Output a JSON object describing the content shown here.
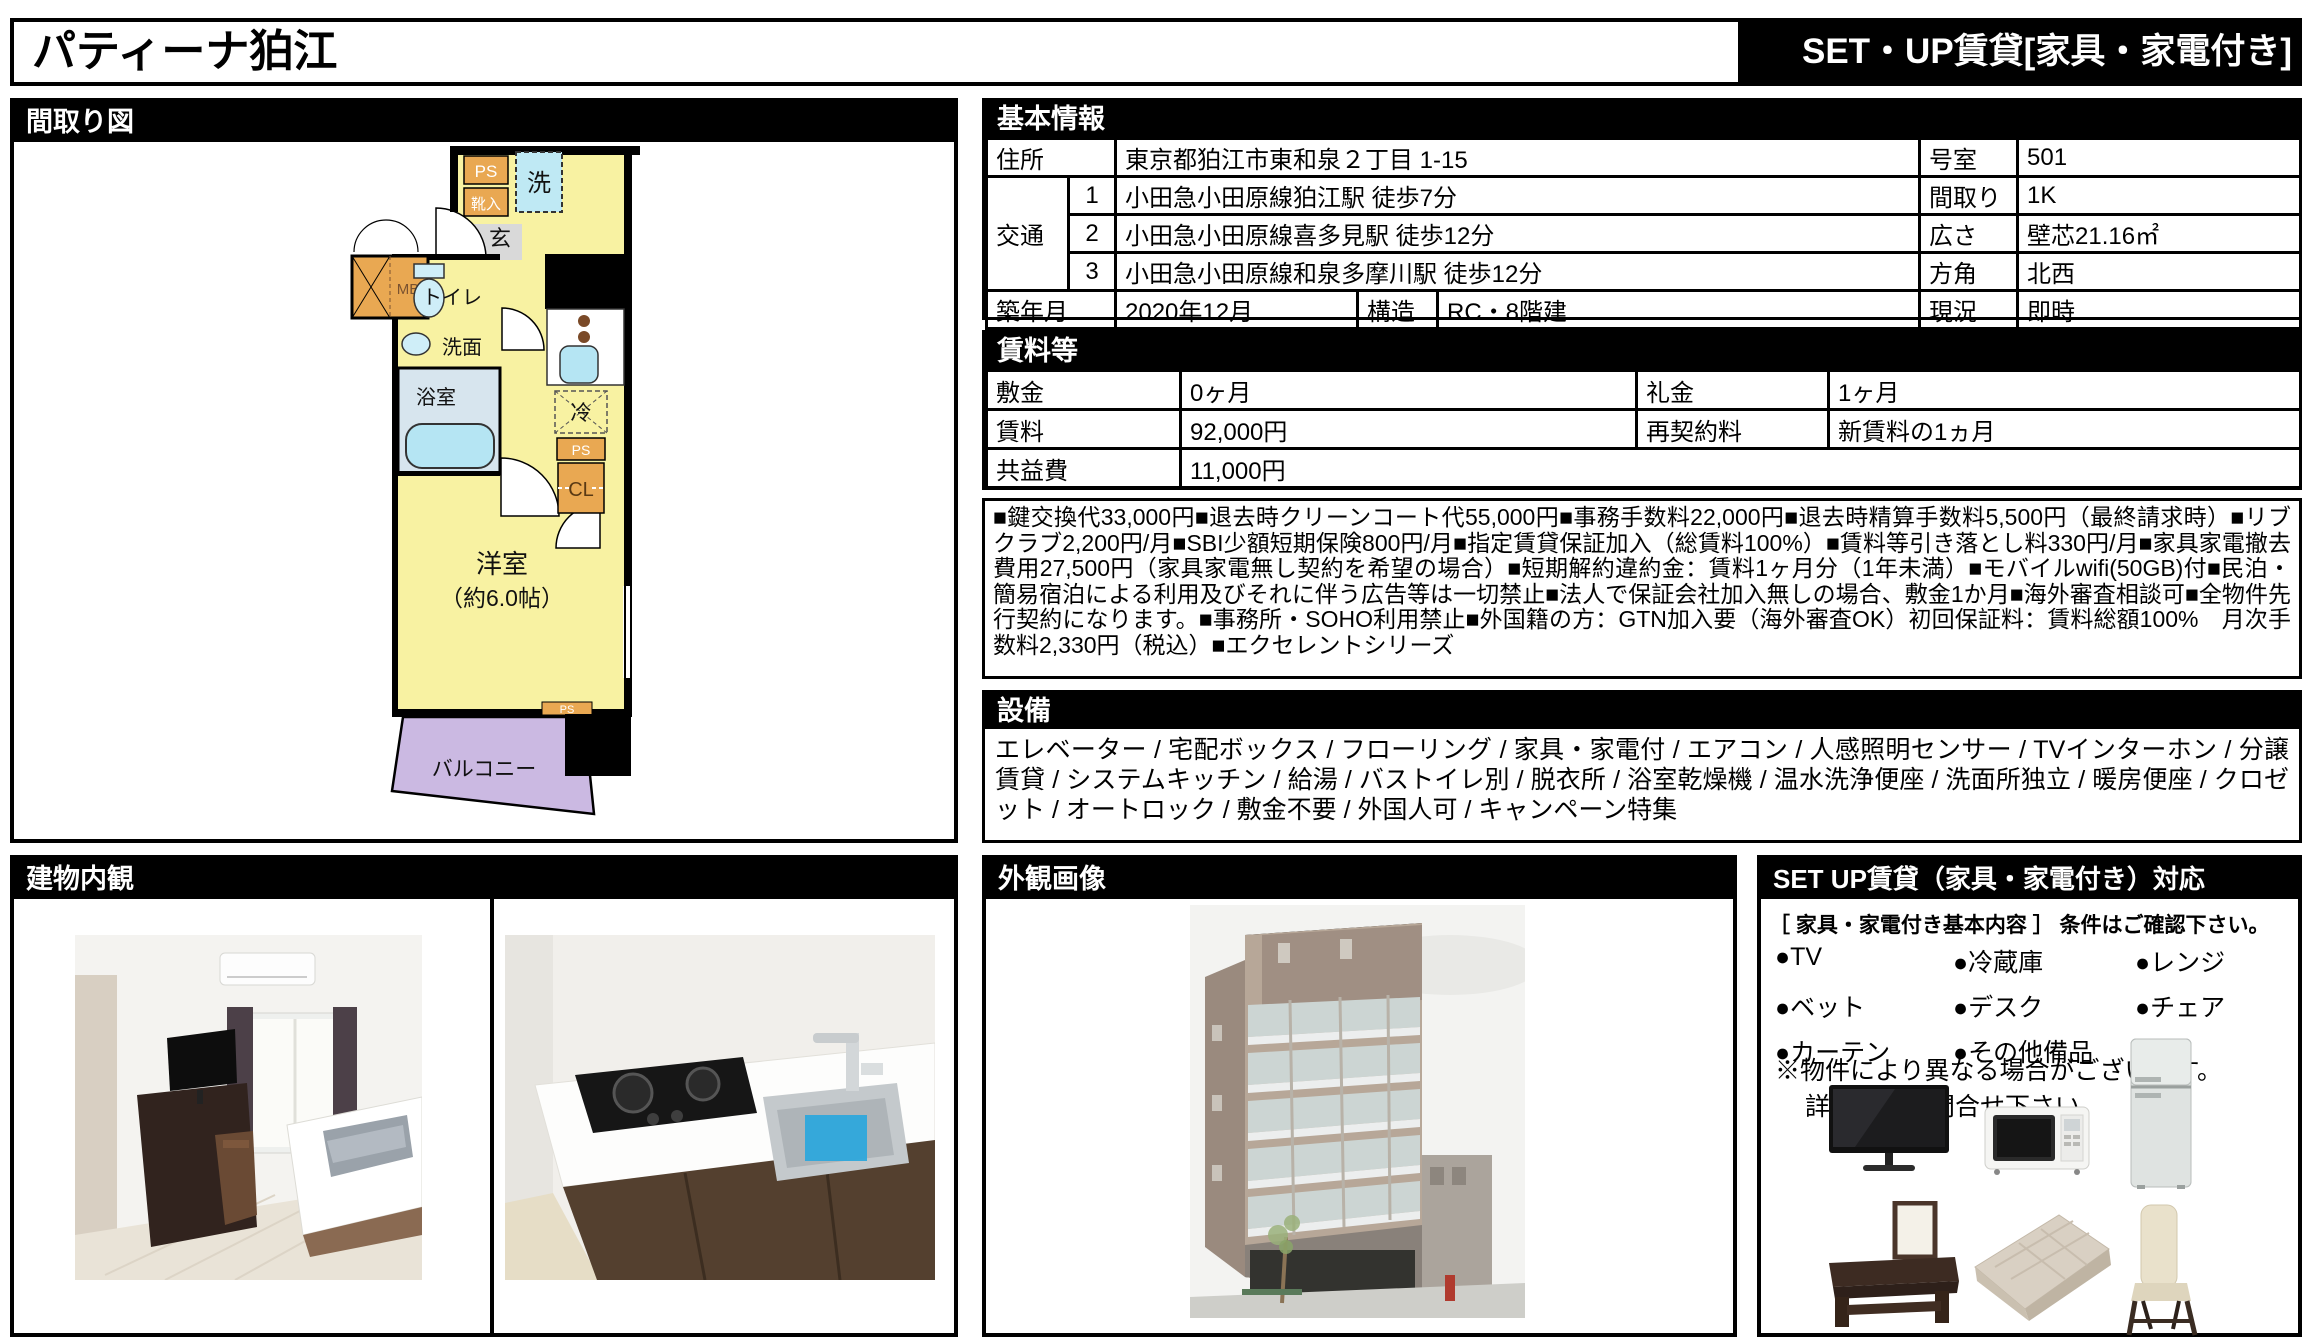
{
  "header": {
    "title": "パティーナ狛江",
    "badge": "SET・UP賃貸[家具・家電付き]"
  },
  "floorplan": {
    "section_title": "間取り図",
    "labels": {
      "ps_top": "PS",
      "shoe_box": "靴入",
      "washer": "洗",
      "entrance": "玄",
      "meter_box": "MB",
      "toilet": "トイレ",
      "washstand": "洗面",
      "bath": "浴室",
      "fridge_space": "冷",
      "ps_mid": "PS",
      "closet": "CL",
      "room": "洋室",
      "room_size": "（約6.0帖）",
      "ps_bottom": "PS",
      "balcony": "バルコニー"
    }
  },
  "basic_info": {
    "section_title": "基本情報",
    "address_label": "住所",
    "address": "東京都狛江市東和泉２丁目 1-15",
    "room_no_label": "号室",
    "room_no": "501",
    "transit_label": "交通",
    "transit": [
      {
        "no": "1",
        "text": "小田急小田原線狛江駅 徒歩7分",
        "right_label": "間取り",
        "right_value": "1K"
      },
      {
        "no": "2",
        "text": "小田急小田原線喜多見駅 徒歩12分",
        "right_label": "広さ",
        "right_value": "壁芯21.16㎡"
      },
      {
        "no": "3",
        "text": "小田急小田原線和泉多摩川駅 徒歩12分",
        "right_label": "方角",
        "right_value": "北西"
      }
    ],
    "built_label": "築年月",
    "built": "2020年12月",
    "structure_label": "構造",
    "structure": "RC・8階建",
    "status_label": "現況",
    "status": "即時"
  },
  "rent": {
    "section_title": "賃料等",
    "deposit_label": "敷金",
    "deposit": "0ヶ月",
    "key_money_label": "礼金",
    "key_money": "1ヶ月",
    "rent_label": "賃料",
    "rent": "92,000円",
    "renewal_label": "再契約料",
    "renewal": "新賃料の1ヵ月",
    "maintenance_label": "共益費",
    "maintenance": "11,000円"
  },
  "notes": "■鍵交換代33,000円■退去時クリーンコート代55,000円■事務手数料22,000円■退去時精算手数料5,500円（最終請求時）■リブクラブ2,200円/月■SBI少額短期保険800円/月■指定賃貸保証加入（総賃料100%）■賃料等引き落とし料330円/月■家具家電撤去費用27,500円（家具家電無し契約を希望の場合）■短期解約違約金：賃料1ヶ月分（1年未満）■モバイルwifi(50GB)付■民泊・簡易宿泊による利用及びそれに伴う広告等は一切禁止■法人で保証会社加入無しの場合、敷金1か月■海外審査相談可■全物件先行契約になります。■事務所・SOHO利用禁止■外国籍の方：GTN加入要（海外審査OK）初回保証料：賃料総額100%　月次手数料2,330円（税込）■エクセレントシリーズ",
  "facilities": {
    "section_title": "設備",
    "text": "エレベーター / 宅配ボックス / フローリング / 家具・家電付 / エアコン / 人感照明センサー / TVインターホン / 分譲賃貸 / システムキッチン / 給湯 / バストイレ別 / 脱衣所 / 浴室乾燥機 / 温水洗浄便座 / 洗面所独立 / 暖房便座 / クロゼット / オートロック / 敷金不要 / 外国人可 / キャンペーン特集"
  },
  "interior": {
    "section_title": "建物内観"
  },
  "exterior": {
    "section_title": "外観画像"
  },
  "setup": {
    "section_title": "SET UP賃貸（家具・家電付き）対応",
    "intro": "［ 家具・家電付き基本内容 ］ 条件はご確認下さい。",
    "items": [
      "●TV",
      "●冷蔵庫",
      "●レンジ",
      "●ベット",
      "●デスク",
      "●チェア",
      "●カーテン",
      "●その他備品"
    ],
    "note1": "※物件により異なる場合がございます。",
    "note2": "詳しくはお問合せ下さい。"
  },
  "colors": {
    "header_black": "#000000",
    "room_yellow": "#f8f2a2",
    "cabinet_orange": "#e9a852",
    "fixture_blue": "#b5e5f3",
    "bath_gray_blue": "#d7e5ee",
    "entrance_gray": "#d9d9d9",
    "balcony_purple": "#cbb9e2"
  }
}
